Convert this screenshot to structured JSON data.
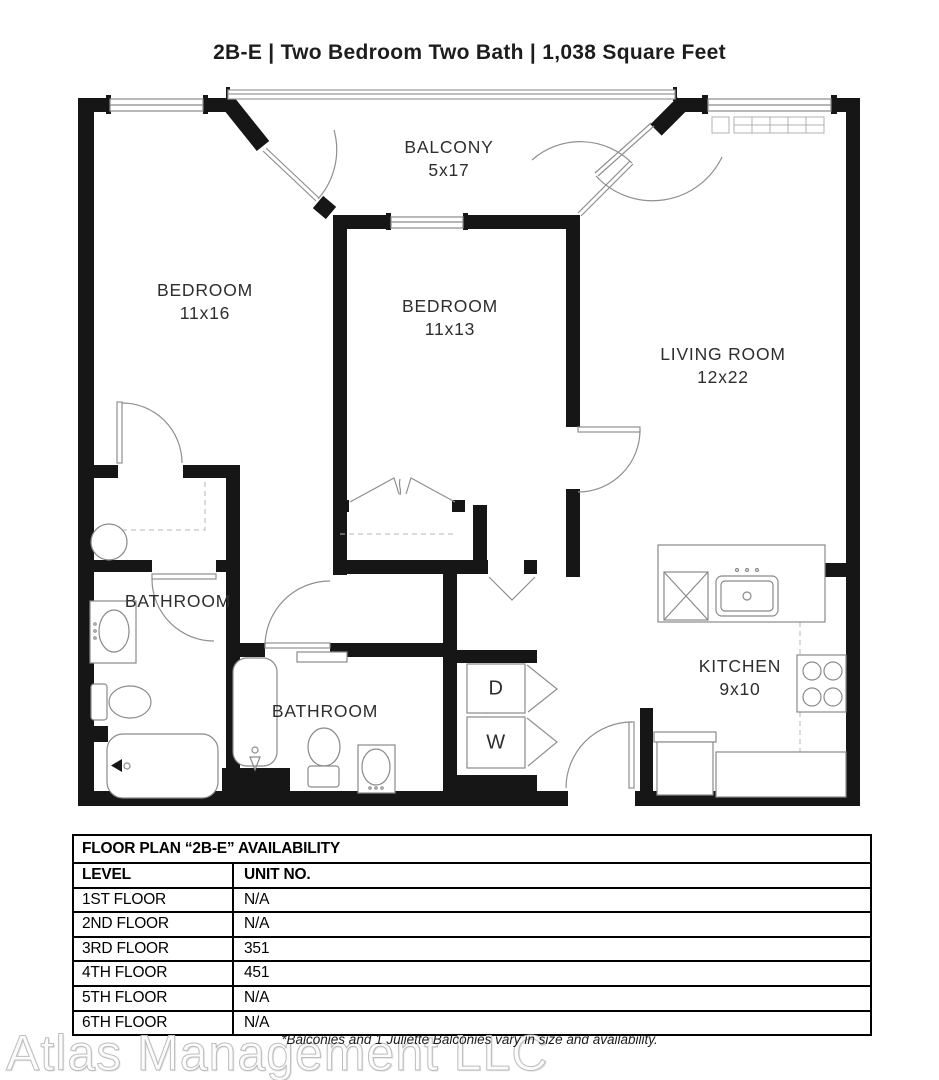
{
  "title": "2B-E | Two Bedroom Two Bath | 1,038 Square Feet",
  "plan": {
    "balcony": {
      "name": "BALCONY",
      "dims": "5x17"
    },
    "bedroom1": {
      "name": "BEDROOM",
      "dims": "11x16"
    },
    "bedroom2": {
      "name": "BEDROOM",
      "dims": "11x13"
    },
    "living": {
      "name": "LIVING ROOM",
      "dims": "12x22"
    },
    "bathroom1": {
      "name": "BATHROOM"
    },
    "bathroom2": {
      "name": "BATHROOM"
    },
    "kitchen": {
      "name": "KITCHEN",
      "dims": "9x10"
    },
    "dryer": "D",
    "washer": "W"
  },
  "table": {
    "title": "FLOOR PLAN “2B-E” AVAILABILITY",
    "columns": {
      "level": "LEVEL",
      "unit": "UNIT NO."
    },
    "rows": [
      {
        "level": "1ST FLOOR",
        "unit": "N/A"
      },
      {
        "level": "2ND FLOOR",
        "unit": "N/A"
      },
      {
        "level": "3RD FLOOR",
        "unit": "351"
      },
      {
        "level": "4TH FLOOR",
        "unit": "451"
      },
      {
        "level": "5TH FLOOR",
        "unit": "N/A"
      },
      {
        "level": "6TH FLOOR",
        "unit": "N/A"
      }
    ]
  },
  "footnote": "*Balconies and 1 Juliette Balconies vary in size and availability.",
  "watermark": "Atlas Management LLC",
  "colors": {
    "wall": "#161616",
    "fixture_line": "#8a8a8a",
    "text": "#2e2e2e"
  }
}
